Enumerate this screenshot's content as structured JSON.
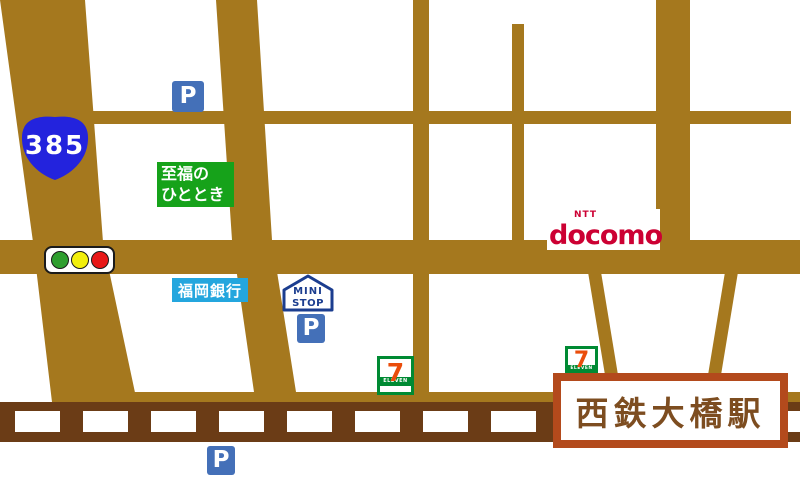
{
  "shield": {
    "number": "385"
  },
  "parking": {
    "label": "P"
  },
  "shifuku_sign": {
    "line1": "至福の",
    "line2": "ひととき"
  },
  "bank_sign": {
    "name": "福岡銀行"
  },
  "ministop_logo": {
    "line1": "MINI",
    "line2": "STOP"
  },
  "docomo_logo": {
    "ntt": "NTT",
    "wordmark": "docomo"
  },
  "seven_eleven_logo": {
    "numeral": "7",
    "banner": "ELEVEN"
  },
  "station_sign": {
    "name": "西鉄大橋駅"
  },
  "colors": {
    "road": "#a5781e",
    "railway": "#6b3c16",
    "route_shield_blue": "#2323dd",
    "parking_blue": "#4470b8",
    "bank_blue": "#24a6de",
    "sign_green": "#16a21a",
    "docomo_red": "#cc0033",
    "seven_green": "#008a33",
    "seven_orange": "#ea4d0b",
    "ministop_navy": "#1b3d8f",
    "station_border": "#b34a1c",
    "station_text": "#7d4d20",
    "traffic_green": "#2f9e2f",
    "traffic_yellow": "#f2ef0c",
    "traffic_red": "#e81717"
  }
}
